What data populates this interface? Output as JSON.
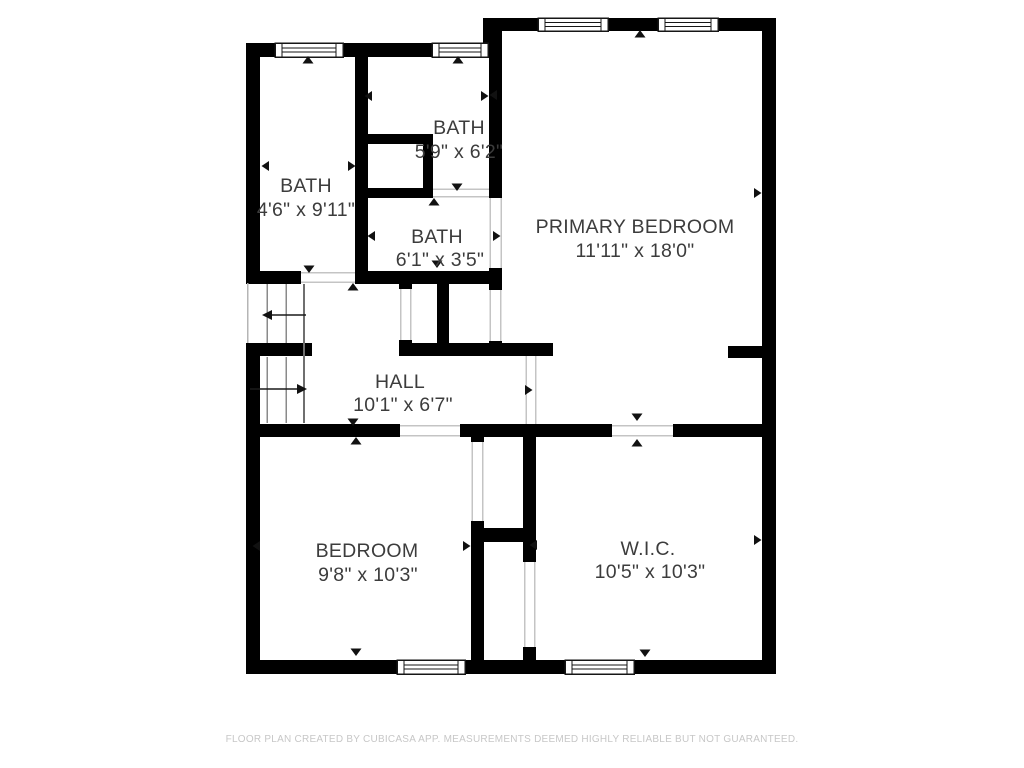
{
  "title": "Floor plan",
  "colors": {
    "wall": "#000000",
    "room_label": "#3c3c3c",
    "door_line": "#c4c4c4",
    "stair_line": "#8a8a8a",
    "footer_text": "#c7c7c7",
    "background": "#ffffff"
  },
  "rooms": {
    "bath_left": {
      "name": "BATH",
      "dims": "4'6\" x 9'11\""
    },
    "bath_top": {
      "name": "BATH",
      "dims": "5'9\" x 6'2\""
    },
    "bath_mid": {
      "name": "BATH",
      "dims": "6'1\" x 3'5\""
    },
    "primary": {
      "name": "PRIMARY BEDROOM",
      "dims": "11'11\" x 18'0\""
    },
    "hall": {
      "name": "HALL",
      "dims": "10'1\" x 6'7\""
    },
    "bedroom": {
      "name": "BEDROOM",
      "dims": "9'8\" x 10'3\""
    },
    "wic": {
      "name": "W.I.C.",
      "dims": "10'5\" x 10'3\""
    }
  },
  "symbols": {
    "window_count": 6,
    "door_opening_count": 10,
    "staircase": "two flights with direction arrows",
    "wall_markers": "small black triangles at room wall midpoints"
  },
  "footer": {
    "text": "FLOOR PLAN CREATED BY CUBICASA APP. MEASUREMENTS DEEMED HIGHLY RELIABLE BUT NOT GUARANTEED."
  }
}
